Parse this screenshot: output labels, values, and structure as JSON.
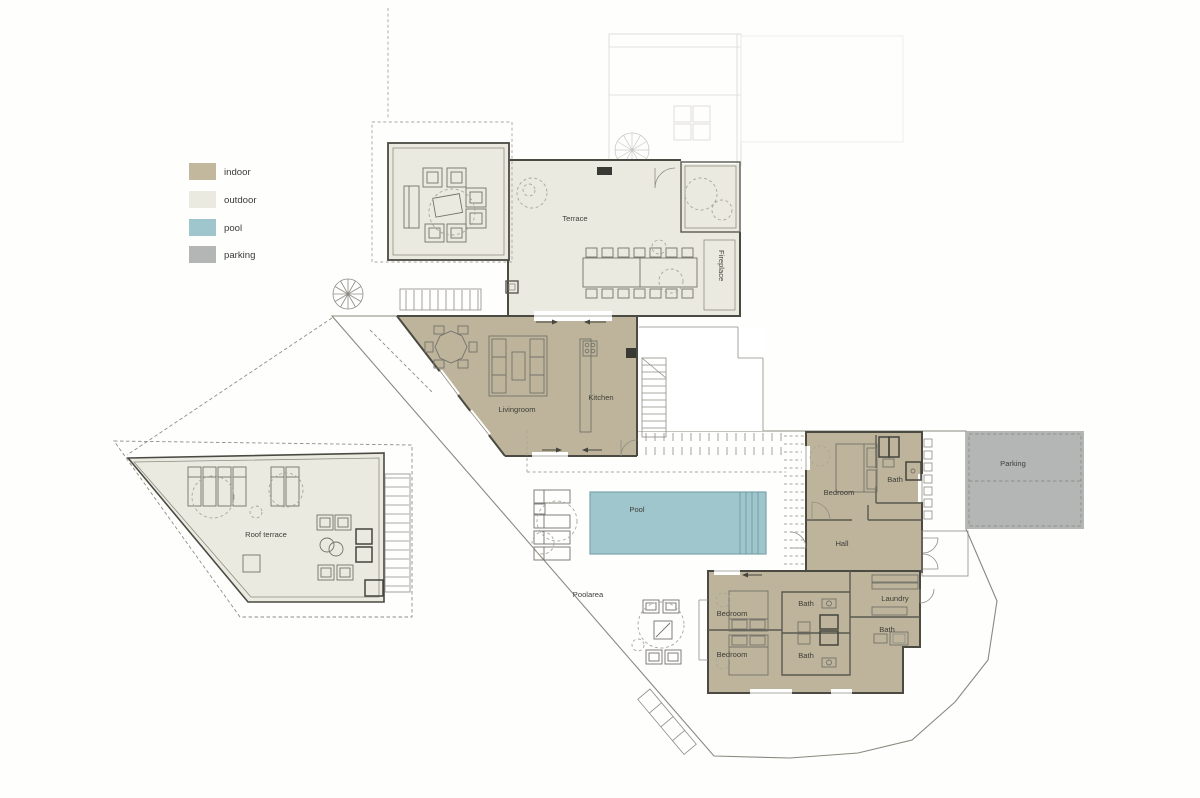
{
  "legend": {
    "items": [
      {
        "label": "indoor",
        "color": "#c2b89e"
      },
      {
        "label": "outdoor",
        "color": "#ebeae0"
      },
      {
        "label": "pool",
        "color": "#9fc6cc"
      },
      {
        "label": "parking",
        "color": "#b4b6b6"
      }
    ]
  },
  "colors": {
    "indoor": "#bdb49b",
    "outdoor": "#ebeae0",
    "pool": "#9fc6cc",
    "parking": "#b4b6b6",
    "wall": "#4a4a42",
    "text": "#3e3e38",
    "white": "#ffffff"
  },
  "labels": {
    "terrace": "Terrace",
    "fireplace": "Fireplace",
    "livingroom": "Livingroom",
    "kitchen": "Kitchen",
    "pool": "Pool",
    "poolarea": "Poolarea",
    "roof_terrace": "Roof terrace",
    "parking": "Parking",
    "hall": "Hall",
    "laundry": "Laundry",
    "bedroom_upper": "Bedroom",
    "bath_upper": "Bath",
    "bedroom_a": "Bedroom",
    "bedroom_b": "Bedroom",
    "bath_center_top": "Bath",
    "bath_center_bottom": "Bath",
    "bath_right": "Bath"
  }
}
